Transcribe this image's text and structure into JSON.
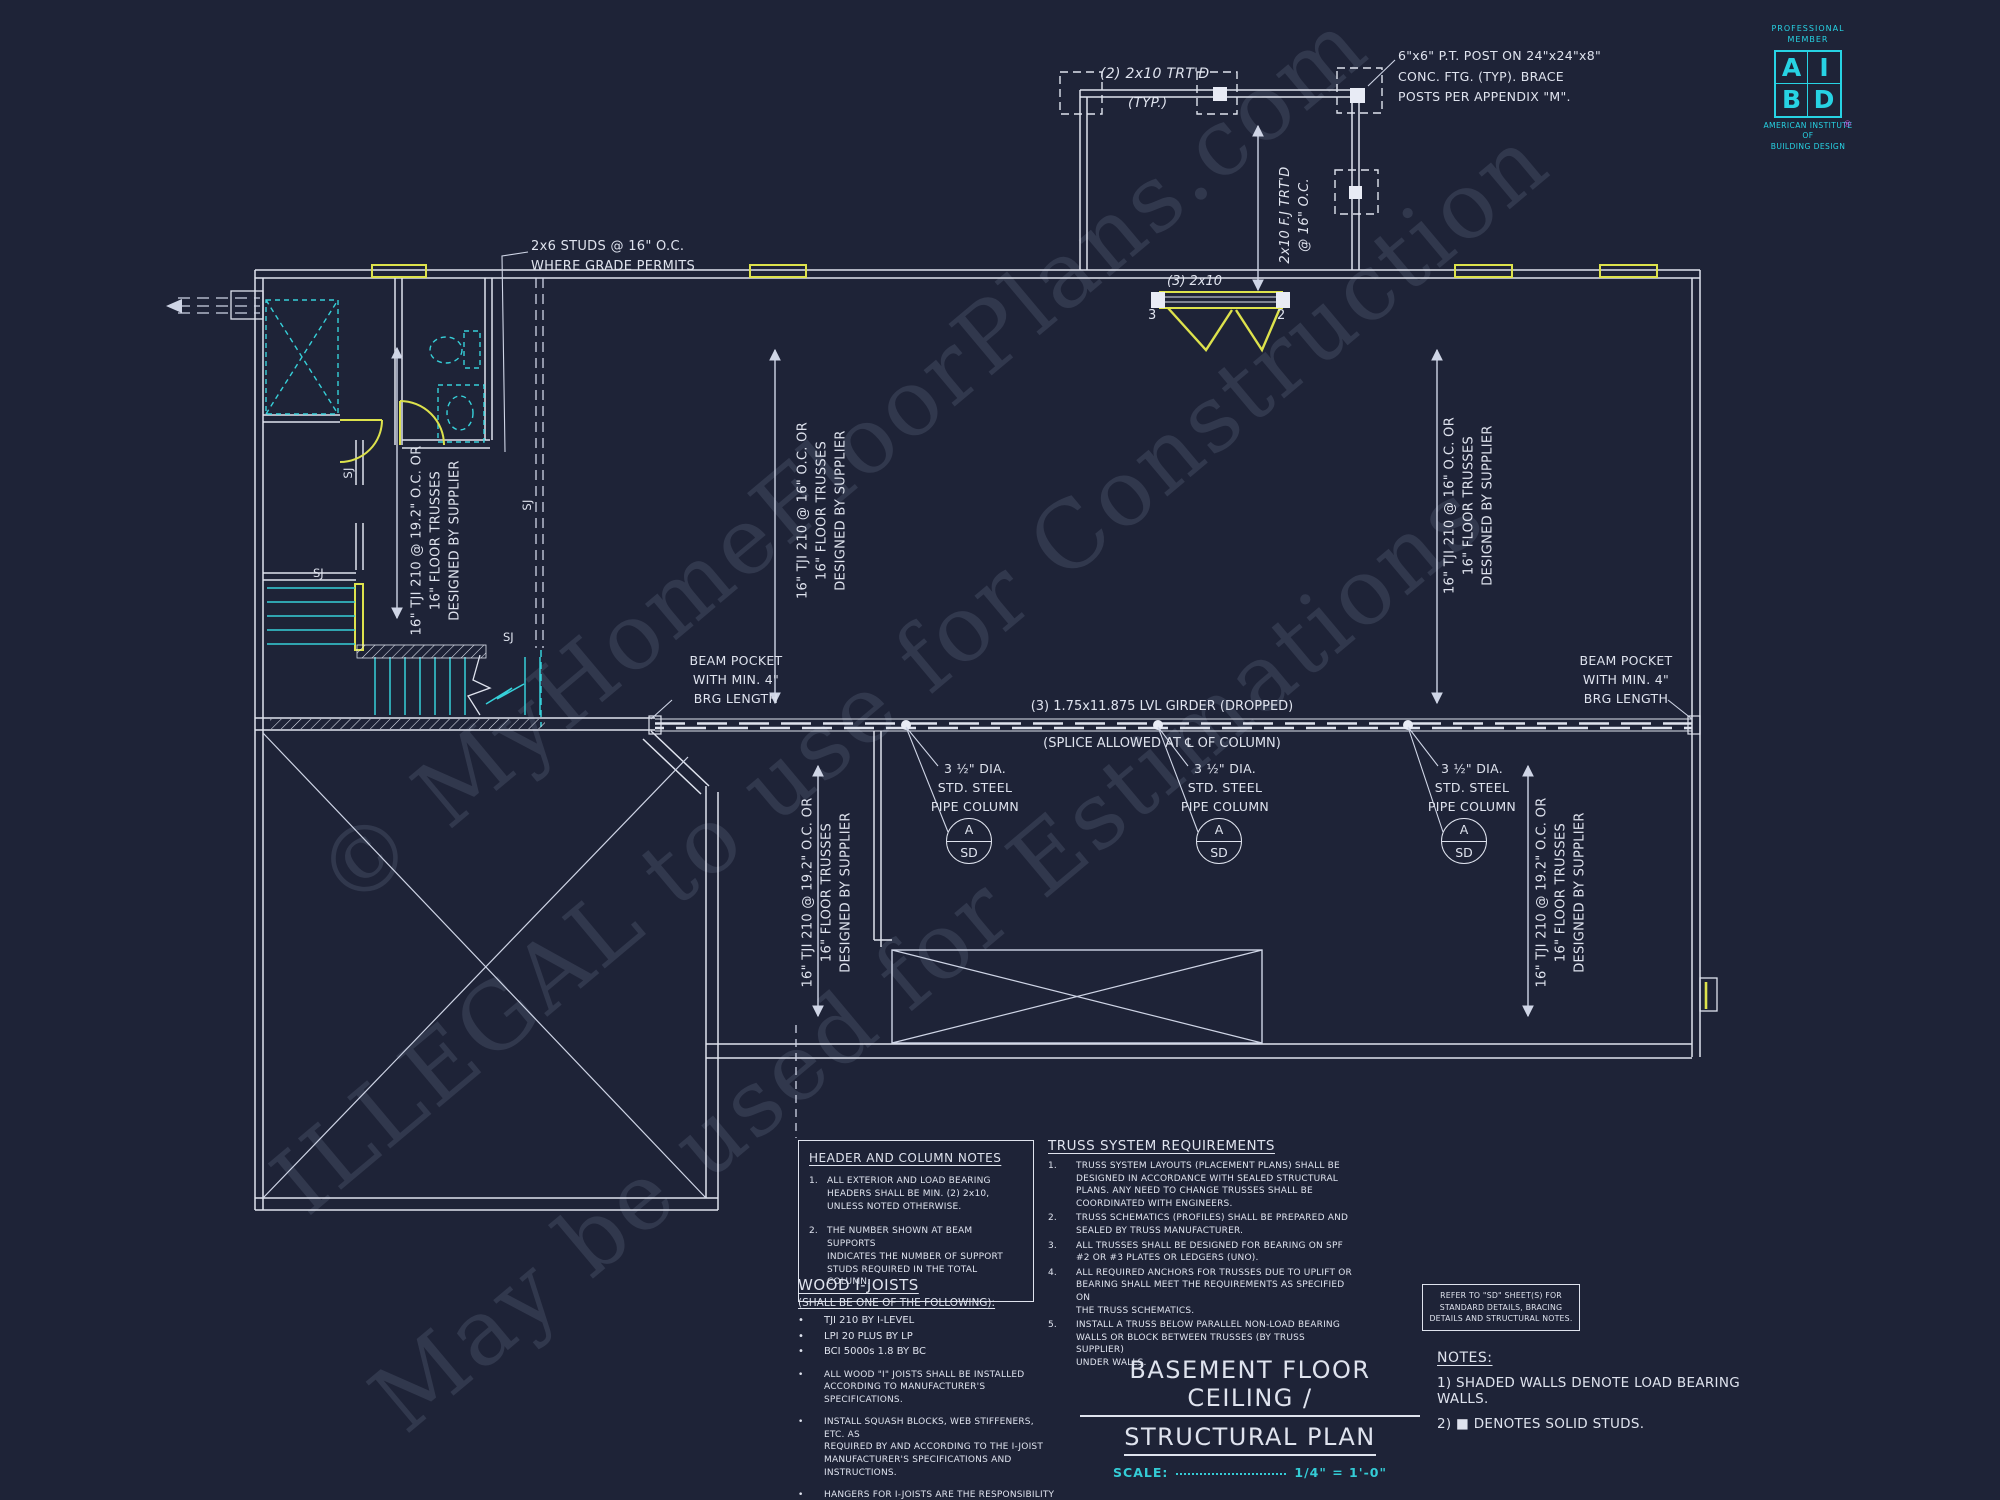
{
  "colors": {
    "background": "#1e2337",
    "line": "#dfe3ee",
    "cyan": "#36d0d9",
    "yellow": "#dde24c",
    "logo_cyan": "#27d3e4",
    "registered_magenta": "#c84fd8",
    "watermark": "rgba(173,183,214,0.14)"
  },
  "watermark": {
    "line1": "© MyHomeFloorPlans.com",
    "line2": "ILLEGAL to use for Construction",
    "line3": "May be used for Estimations"
  },
  "logo": {
    "member": "PROFESSIONAL\nMEMBER",
    "letter_a": "A",
    "letter_i": "I",
    "letter_b": "B",
    "letter_d": "D",
    "registered": "®",
    "org": "AMERICAN INSTITUTE\nOF\nBUILDING DESIGN"
  },
  "plan": {
    "post_note": "6\"x6\" P.T. POST ON 24\"x24\"x8\"\nCONC. FTG. (TYP). BRACE\nPOSTS PER APPENDIX \"M\".",
    "deck_beam_label": "(2) 2x10 TRT'D",
    "deck_typ": "(TYP.)",
    "deck_joist_label": "2x10 F.J TRT'D\n@ 16\" O.C.",
    "header_label": "(3) 2x10",
    "header_left_count": "3",
    "header_right_count": "2",
    "studs_note": "2x6 STUDS @ 16\" O.C.\nWHERE GRADE PERMITS",
    "beam_pocket_note": "BEAM POCKET\nWITH MIN. 4\"\nBRG LENGTH",
    "girder_label": "(3) 1.75x11.875 LVL GIRDER (DROPPED)",
    "splice_label": "(SPLICE ALLOWED AT ℄ OF COLUMN)",
    "pipe_column_note": "3 ½\" DIA.\nSTD. STEEL\nPIPE COLUMN",
    "bubble": {
      "top": "A",
      "bottom": "SD"
    },
    "joist_label_192": "16\" TJI 210 @ 19.2\" O.C. OR\n16\" FLOOR TRUSSES\nDESIGNED BY SUPPLIER",
    "joist_label_16": "16\" TJI 210 @ 16\" O.C. OR\n16\" FLOOR TRUSSES\nDESIGNED BY SUPPLIER",
    "sj": "SJ"
  },
  "header_notes": {
    "title": "HEADER AND COLUMN NOTES",
    "items": [
      {
        "n": "1.",
        "text": "ALL EXTERIOR AND LOAD BEARING\nHEADERS SHALL BE MIN. (2) 2x10,\nUNLESS NOTED OTHERWISE."
      },
      {
        "n": "2.",
        "text": "THE NUMBER SHOWN AT BEAM SUPPORTS\nINDICATES THE NUMBER OF SUPPORT\nSTUDS REQUIRED IN THE TOTAL COLUMN."
      }
    ]
  },
  "truss": {
    "title": "TRUSS SYSTEM REQUIREMENTS",
    "items": [
      {
        "n": "1.",
        "text": "TRUSS SYSTEM LAYOUTS (PLACEMENT PLANS) SHALL BE\nDESIGNED IN ACCORDANCE WITH SEALED STRUCTURAL\nPLANS. ANY NEED TO CHANGE TRUSSES SHALL BE\nCOORDINATED WITH ENGINEERS."
      },
      {
        "n": "2.",
        "text": "TRUSS SCHEMATICS (PROFILES) SHALL BE PREPARED AND\nSEALED BY TRUSS MANUFACTURER."
      },
      {
        "n": "3.",
        "text": "ALL TRUSSES SHALL BE DESIGNED FOR BEARING ON SPF\n#2 OR #3 PLATES OR LEDGERS (UNO)."
      },
      {
        "n": "4.",
        "text": "ALL REQUIRED ANCHORS FOR TRUSSES DUE TO UPLIFT OR\nBEARING SHALL MEET THE REQUIREMENTS AS SPECIFIED ON\nTHE TRUSS SCHEMATICS."
      },
      {
        "n": "5.",
        "text": "INSTALL A TRUSS BELOW PARALLEL NON-LOAD BEARING\nWALLS OR BLOCK BETWEEN TRUSSES (BY TRUSS SUPPLIER)\nUNDER WALLS."
      }
    ]
  },
  "wood": {
    "title": "WOOD I-JOISTS",
    "subtitle": "(SHALL BE ONE OF THE FOLLOWING):",
    "bullet": "•",
    "options": [
      "TJI 210 BY I-LEVEL",
      "LPI 20 PLUS BY LP",
      "BCI 5000s 1.8 BY BC"
    ],
    "items": [
      "ALL WOOD \"I\" JOISTS SHALL BE INSTALLED\nACCORDING TO MANUFACTURER'S SPECIFICATIONS.",
      "INSTALL SQUASH BLOCKS, WEB STIFFENERS, ETC. AS\nREQUIRED BY AND ACCORDING TO THE I-JOIST\nMANUFACTURER'S SPECIFICATIONS AND INSTRUCTIONS.",
      "HANGERS FOR I-JOISTS ARE THE RESPONSIBILITY OF\nTHE I-JOIST SUPPLIER."
    ]
  },
  "sd_box": {
    "text": "REFER TO \"SD\" SHEET(S) FOR\nSTANDARD DETAILS, BRACING\nDETAILS AND STRUCTURAL NOTES."
  },
  "title_block": {
    "line1": "BASEMENT FLOOR CEILING /",
    "line2": "STRUCTURAL PLAN",
    "scale_label": "SCALE:",
    "scale_value": "1/4\" = 1'-0\""
  },
  "notes": {
    "heading": "NOTES:",
    "item1": "1) SHADED WALLS DENOTE LOAD BEARING WALLS.",
    "item2": "2) ■ DENOTES SOLID STUDS."
  }
}
